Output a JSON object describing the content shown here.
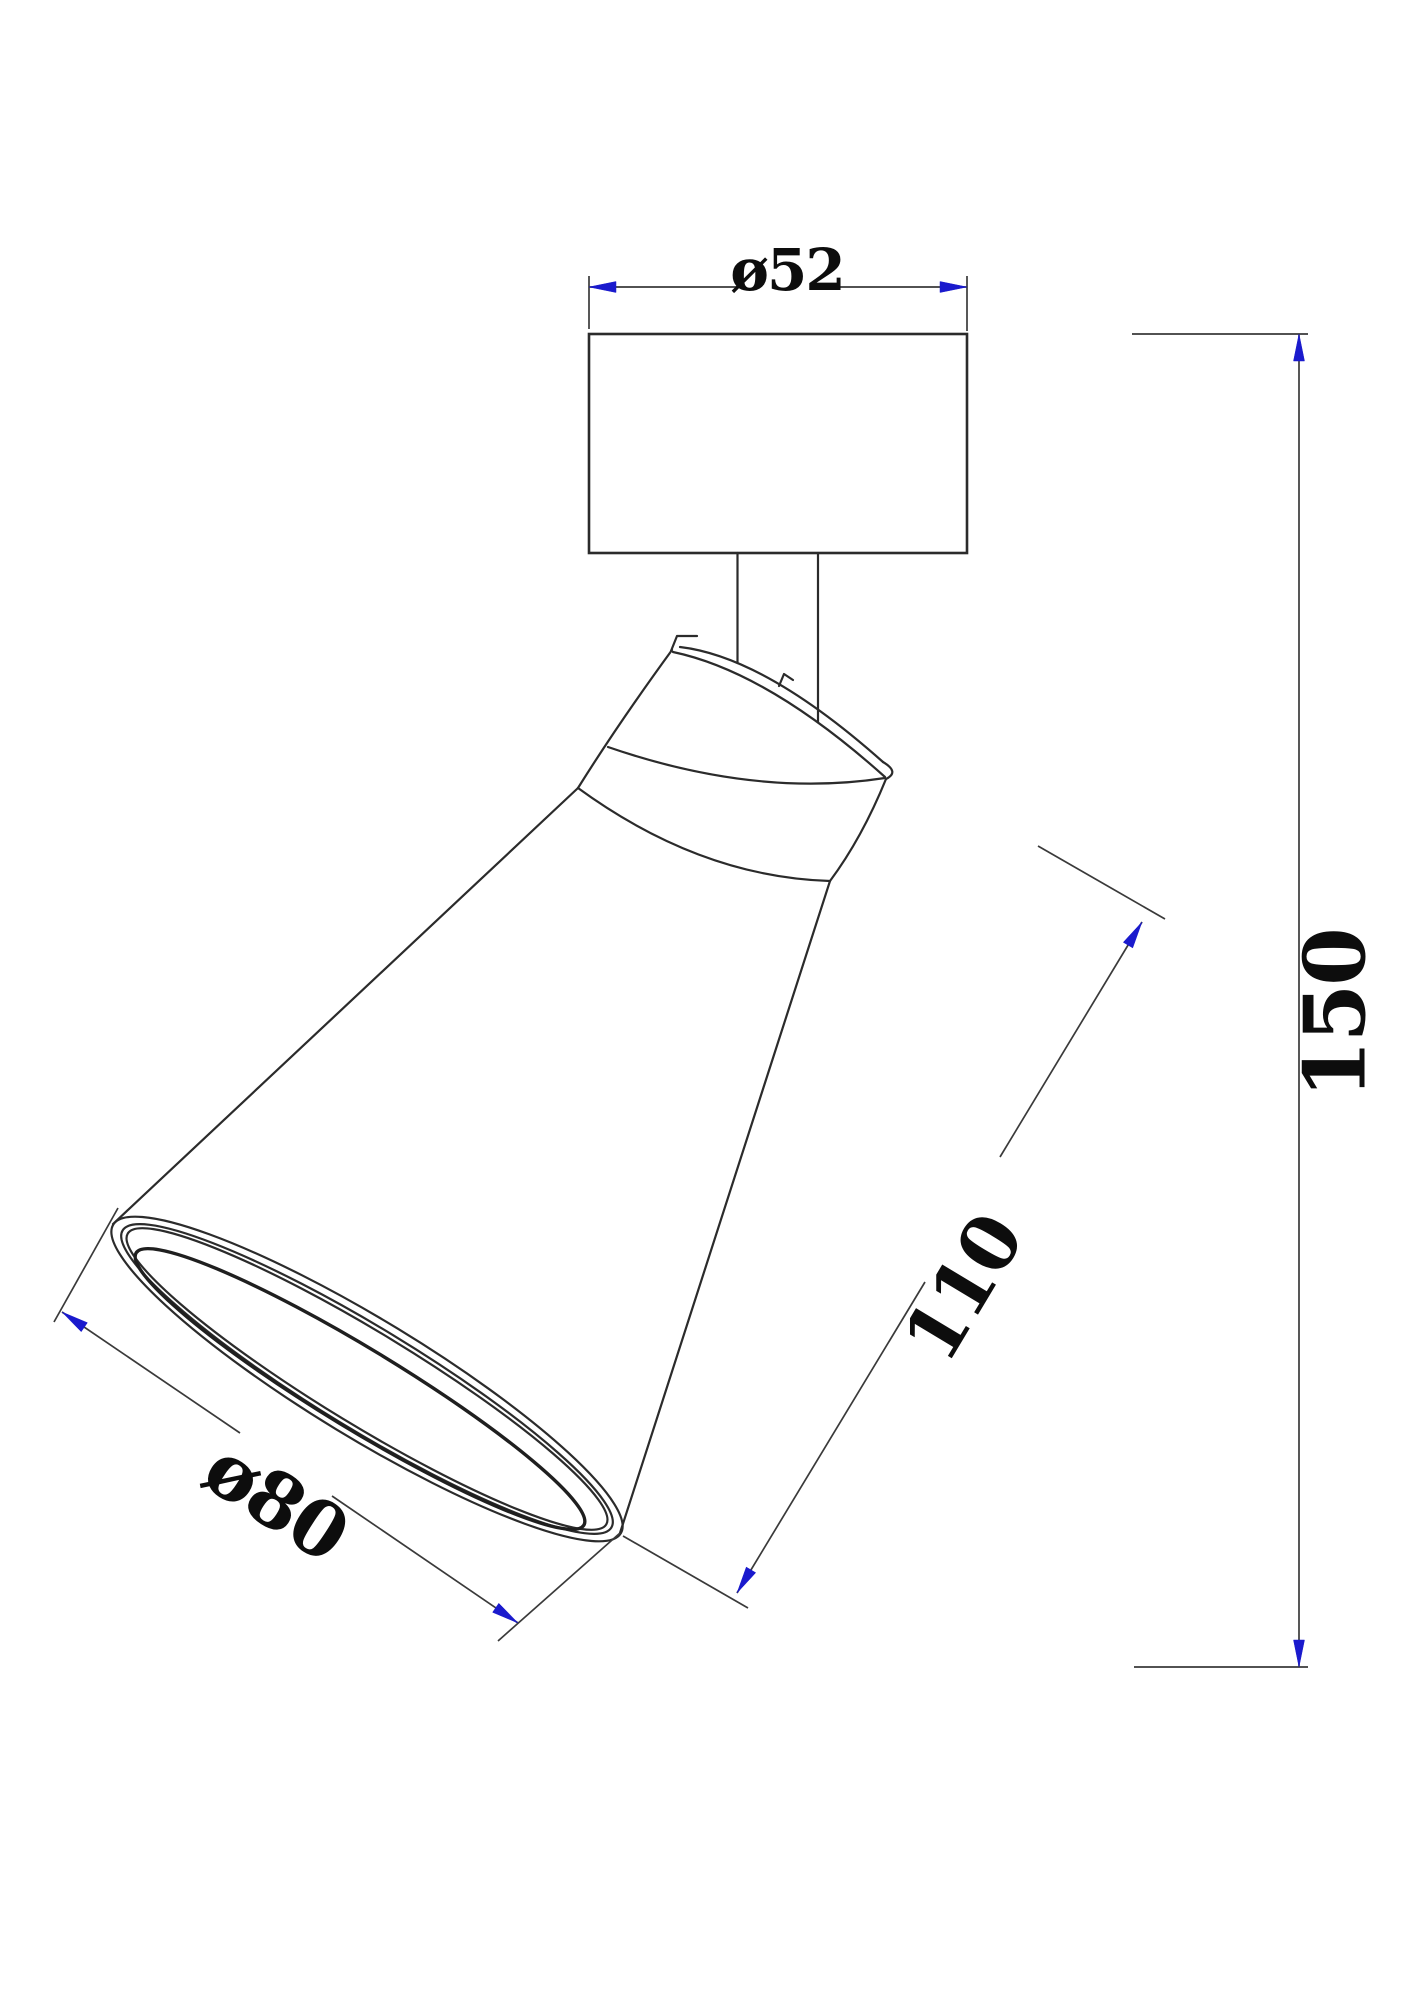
{
  "drawing": {
    "description": "technical dimension drawing of a ceiling spot light",
    "dimensions": {
      "top_diameter": {
        "label": "ø52",
        "value": "52"
      },
      "overall_height": {
        "label": "150",
        "value": "150"
      },
      "head_length": {
        "label": "110",
        "value": "110"
      },
      "opening_diameter": {
        "label": "ø80",
        "value": "80"
      }
    },
    "colors": {
      "outline": "#2b2b2b",
      "dimension_line": "#3a3a3a",
      "arrow": "#1a1acd",
      "text": "#0d0d0d",
      "background": "#ffffff"
    }
  }
}
